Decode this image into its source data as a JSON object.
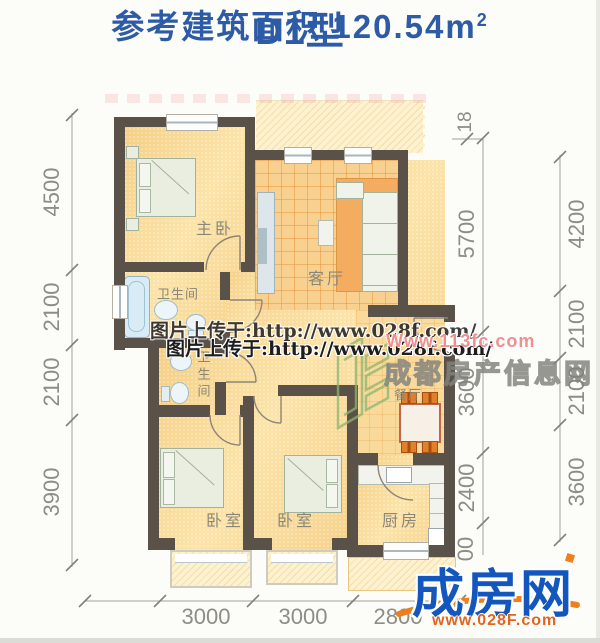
{
  "title": {
    "type": "D1型",
    "area_label": "参考建筑面积  120.54m",
    "area_sup": "2"
  },
  "rooms": {
    "master": "主卧",
    "living": "客厅",
    "bath1": "卫生间",
    "bath2": "卫生间",
    "bed1": "卧室",
    "bed2": "卧室",
    "dining": "餐厅",
    "kitchen": "厨房"
  },
  "dims": {
    "left": [
      "4500",
      "2100",
      "2100",
      "3900"
    ],
    "right_inner": [
      "18",
      "5700",
      "3600",
      "2400",
      "00"
    ],
    "right_outer": [
      "4200",
      "2100",
      "2100",
      "3600"
    ],
    "bottom": [
      "3000",
      "3000",
      "2800"
    ]
  },
  "watermarks": {
    "upload_text": "图片上传于:http://www.028f.com/",
    "site_pink": "Www.113fc.com",
    "site_gray": "成都房产信息网"
  },
  "logo": {
    "brand": "成房网",
    "url": "www.028F.com"
  },
  "colors": {
    "title_blue": "#2d5ba6",
    "wall": "#5a5148",
    "floor_yellow": "#f8d68f",
    "tile_line": "#e99840",
    "dim_gray": "#8d8d86",
    "logo_blue": "#1356bd",
    "logo_orange": "#ef7f1d",
    "watermark_pink": "#ef8f8f"
  }
}
